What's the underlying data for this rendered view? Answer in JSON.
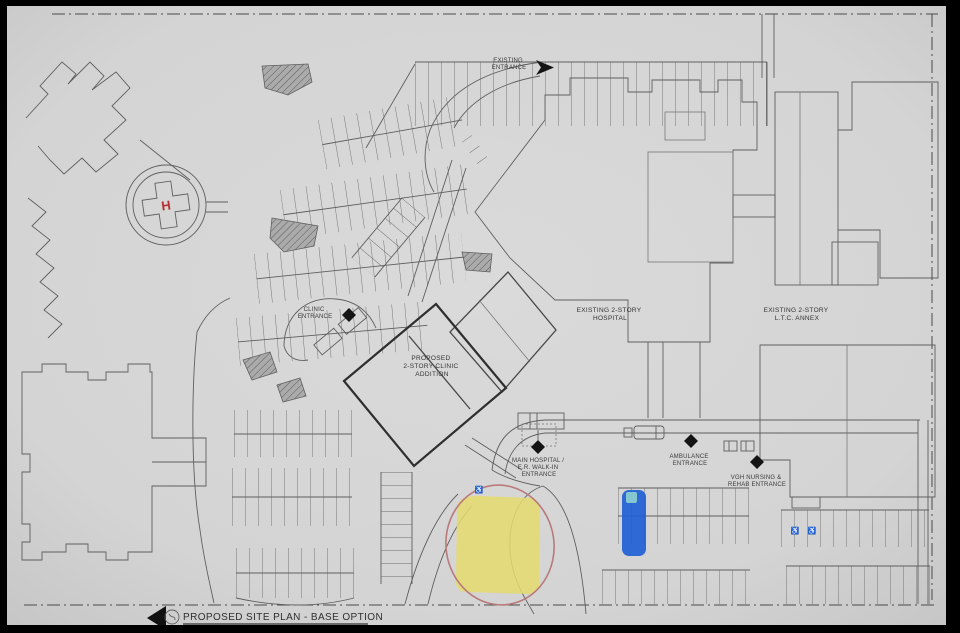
{
  "page": {
    "background": "#000000",
    "paper_color": "#d6d6d6"
  },
  "title_block": {
    "title": "PROPOSED SITE PLAN - BASE OPTION"
  },
  "buildings": {
    "hospital": {
      "line1": "EXISTING 2-STORY",
      "line2": "HOSPITAL"
    },
    "annex": {
      "line1": "EXISTING 2-STORY",
      "line2": "L.T.C. ANNEX"
    },
    "addition": {
      "line1": "PROPOSED",
      "line2": "2-STORY CLINIC",
      "line3": "ADDITION"
    }
  },
  "entrances": {
    "existing": {
      "line1": "EXISTING",
      "line2": "ENTRANCE"
    },
    "clinic": {
      "line1": "CLINIC",
      "line2": "ENTRANCE"
    },
    "main": {
      "line1": "MAIN HOSPITAL /",
      "line2": "E.R. WALK-IN",
      "line3": "ENTRANCE"
    },
    "ambulance": {
      "line1": "AMBULANCE",
      "line2": "ENTRANCE"
    },
    "vgh": {
      "line1": "VGH NURSING &",
      "line2": "REHAB ENTRANCE"
    }
  },
  "helipad": {
    "symbol": "H",
    "symbol_color": "#b53131"
  },
  "icons": {
    "wheelchair": "♿"
  },
  "highlights": {
    "yellow_area_color": "#e5da6e",
    "blue_stall_color": "#2160d6",
    "annotation_circle_color": "#b97a7a"
  },
  "colors": {
    "drawing_line": "#5f5f5f",
    "heavy_line": "#2e2e2e",
    "boundary_line": "#4a4a4a",
    "hatch_fill": "#a6a6a6"
  }
}
